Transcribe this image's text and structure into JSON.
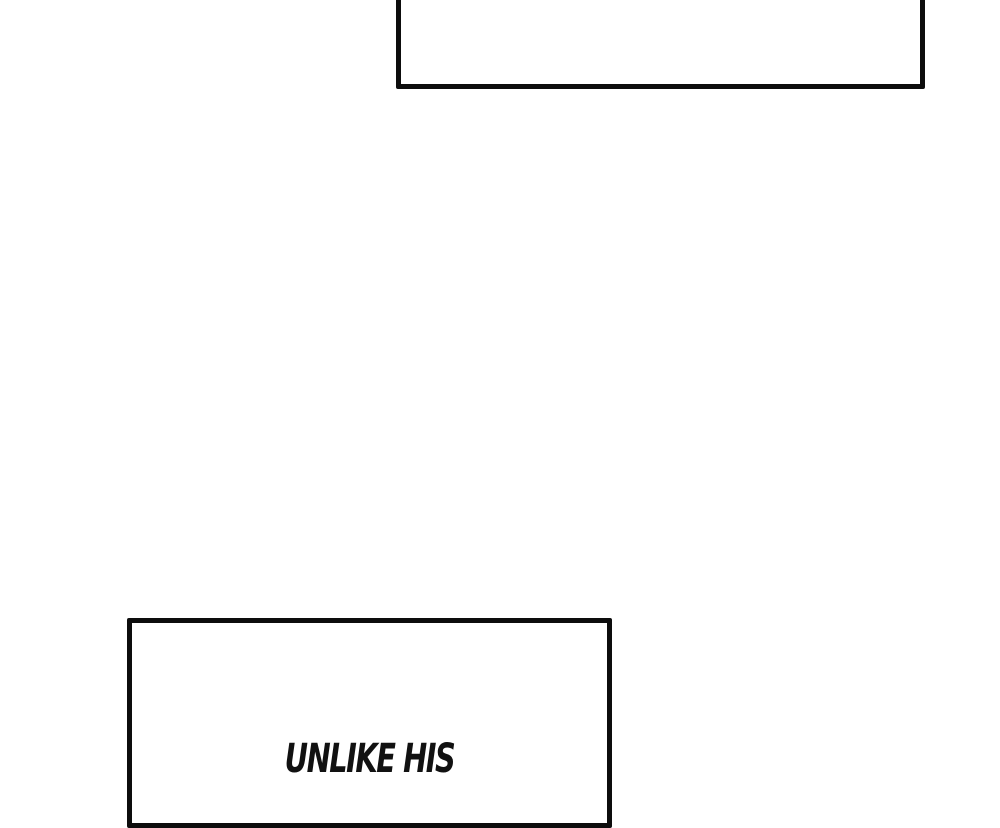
{
  "page": {
    "background_color": "#ffffff",
    "panel_border_color": "#0d0d0d",
    "text_color": "#111111"
  },
  "panels": {
    "top_caption": {
      "text": ""
    },
    "bottom_caption": {
      "text": "UNLIKE HIS"
    }
  }
}
